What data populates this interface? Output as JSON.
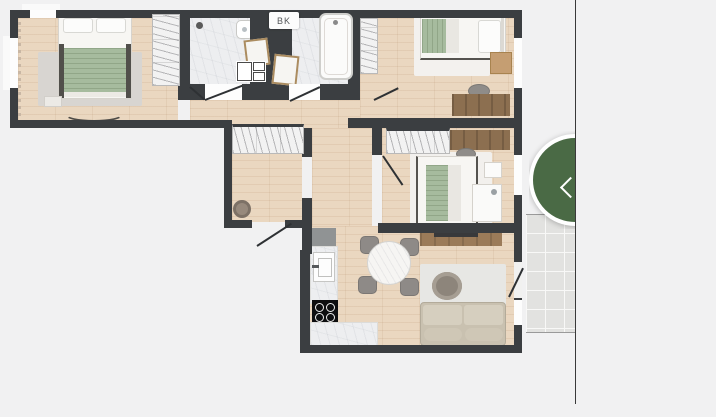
{
  "floorplan": {
    "label_bk": "BK",
    "rooms": [
      "bedroom-1",
      "bathroom-1",
      "bathroom-2",
      "bedroom-2",
      "hallway",
      "bedroom-3",
      "living-room-kitchen",
      "balcony"
    ],
    "colors": {
      "wall": "#3b3e41",
      "wood_floor": "#e9d5bd",
      "tile_floor": "#edeef0",
      "balcony_tile": "#e2e2e0",
      "blanket_sage": "#a6bb9e",
      "sofa_beige": "#c9c1b0"
    }
  },
  "panel_toggle": {
    "icon": "chevron-left",
    "shape": "circle",
    "color": "#4a6a45",
    "ring_color": "#ffffff"
  },
  "divider": {
    "color": "#3a3a3a"
  }
}
